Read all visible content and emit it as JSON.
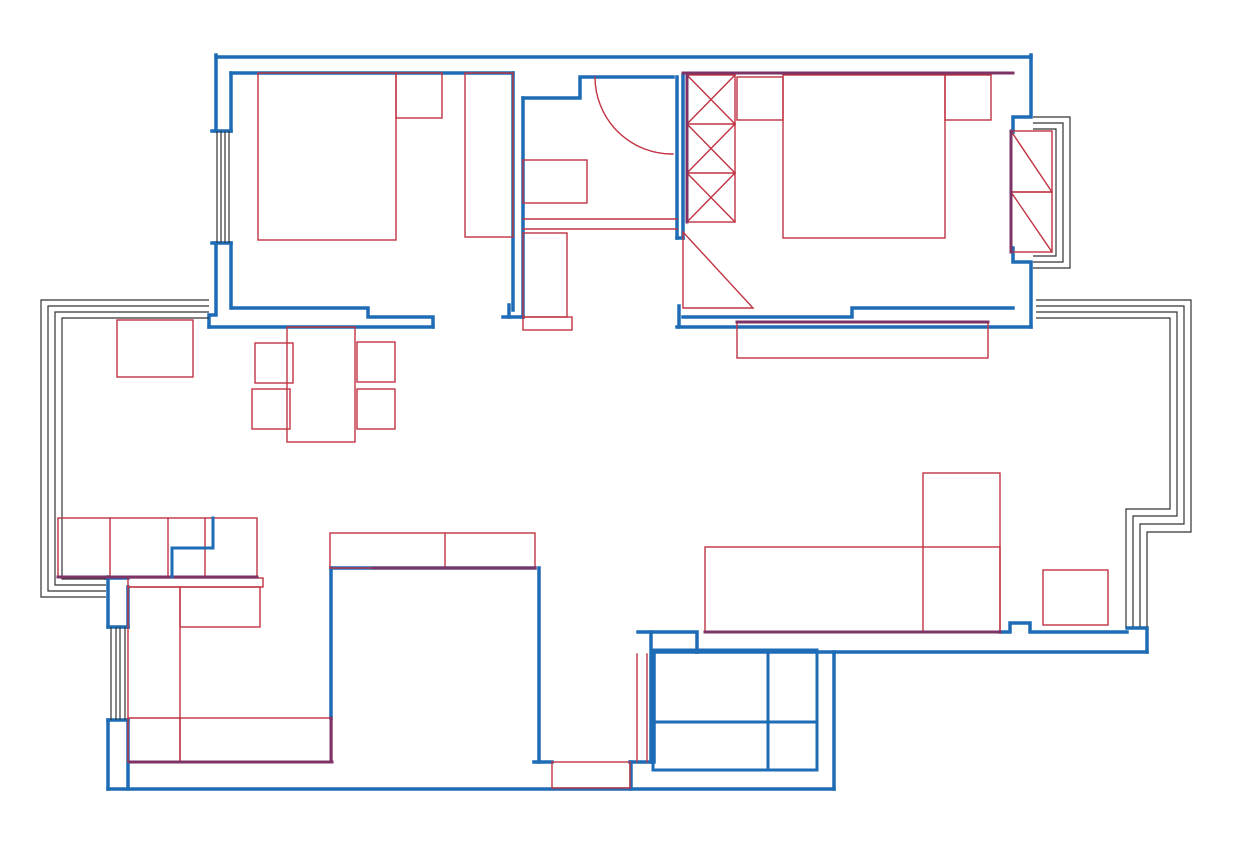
{
  "meta": {
    "description": "apartment-floor-plan-cad-drawing",
    "canvas": {
      "width": 1239,
      "height": 849,
      "background": "#ffffff"
    },
    "colors": {
      "wall_blue": "#1e6cb5",
      "furniture_red": "#c13343",
      "overlap_purple": "#7d3366",
      "frame_dark": "#333333"
    },
    "stroke_widths": {
      "wall": 3.5,
      "furniture": 1.4,
      "frame": 1.2,
      "overlap": 3,
      "fixture": 3
    }
  },
  "walls": [
    "M 216 57 H 1031",
    "M 216 55 V 131",
    "M 216 243 V 315 H 209 V 327",
    "M 209 327 H 433",
    "M 233 308 H 368 V 317 H 433 V 327",
    "M 231 73 V 131",
    "M 231 243 V 308",
    "M 231 73 H 513",
    "M 513 73 V 310",
    "M 523 98 V 317",
    "M 523 98 H 580 V 77 H 673",
    "M 677 77 V 238",
    "M 683 75 V 238",
    "M 677 238 H 683",
    "M 679 306 V 327",
    "M 683 317 H 852 V 308 H 1013",
    "M 677 327 H 1031",
    "M 1031 55 V 117 H 1013 V 132",
    "M 1013 248 V 262 H 1031 V 327",
    "M 212 131 H 231",
    "M 212 243 H 231",
    "M 108 627 H 128",
    "M 108 720 H 128",
    "M 509 305 V 317",
    "M 503 317 H 523",
    "M 638 632 H 697 V 652",
    "M 654 652 H 697",
    "M 697 652 H 1147",
    "M 1000 632 H 1010 V 623 H 1030 V 632 H 1127",
    "M 1127 628 H 1147 V 652",
    "M 651 632 V 762",
    "M 654 652 V 762",
    "M 630 762 H 653",
    "M 631 762 V 789",
    "M 108 789 H 834",
    "M 834 652 V 789",
    "M 539 568 V 762",
    "M 534 762 H 552",
    "M 331 568 H 535",
    "M 331 568 V 718"
  ],
  "kitchen_walls": [
    "M 108 577 V 627",
    "M 108 720 V 789",
    "M 128 587 V 627",
    "M 128 720 V 789",
    "M 106 578 H 128"
  ],
  "blue_fixtures": [
    "M 213 518 V 548 H 172 V 577",
    "M 653 650 H 817 V 770 H 653 Z",
    "M 768 650 V 770",
    "M 657 722 H 817"
  ],
  "overlap_lines": [
    "M 683 73 H 1013",
    "M 737 322 H 988",
    "M 705 632 H 1000",
    "M 58 577 H 257",
    "M 130 762 H 332",
    "M 331 718 V 762",
    "M 373 568 H 535",
    "M 687 75 V 222",
    "M 1011 131 V 252"
  ],
  "window_lines": [
    "M 217 131 V 243",
    "M 221 131 V 243",
    "M 225 131 V 243",
    "M 229 131 V 243",
    "M 111 627 V 720",
    "M 116 627 V 720",
    "M 120 627 V 720",
    "M 125 627 V 720",
    "M 1033 117 H 1070 V 268 H 1033",
    "M 1033 123 H 1063 V 262 H 1033",
    "M 1033 129 H 1056 V 256 H 1033"
  ],
  "railing_lines": [
    "M 209 300 H 41 V 597 H 106",
    "M 209 306 H 48 V 591 H 106",
    "M 209 312 H 55 V 585 H 106",
    "M 209 318 H 62 V 579 H 106",
    "M 1036 300 H 1191 V 532 H 1147 V 627",
    "M 1036 306 H 1184 V 524 H 1140 V 627",
    "M 1036 312 H 1177 V 516 H 1133 V 627",
    "M 1036 318 H 1170 V 509 H 1126 V 627"
  ],
  "furniture_rects": [
    {
      "name": "bed-left-bedroom",
      "x": 258,
      "y": 73,
      "w": 138,
      "h": 167
    },
    {
      "name": "nightstand-left-bedroom",
      "x": 396,
      "y": 73,
      "w": 46,
      "h": 45
    },
    {
      "name": "wardrobe-left-bedroom",
      "x": 465,
      "y": 73,
      "w": 48,
      "h": 164
    },
    {
      "name": "bathroom-cabinet",
      "x": 523,
      "y": 160,
      "w": 64,
      "h": 43
    },
    {
      "name": "hall-tall-cabinet",
      "x": 523,
      "y": 233,
      "w": 44,
      "h": 84
    },
    {
      "name": "hall-small-cabinet",
      "x": 523,
      "y": 317,
      "w": 49,
      "h": 13
    },
    {
      "name": "wardrobe-right-bedroom",
      "x": 687,
      "y": 75,
      "w": 48,
      "h": 147
    },
    {
      "name": "nightstand-right-bedroom-left",
      "x": 737,
      "y": 77,
      "w": 46,
      "h": 43
    },
    {
      "name": "bed-right-bedroom",
      "x": 783,
      "y": 75,
      "w": 162,
      "h": 163
    },
    {
      "name": "nightstand-right-bedroom-right",
      "x": 945,
      "y": 75,
      "w": 46,
      "h": 45
    },
    {
      "name": "radiator-upper",
      "x": 1011,
      "y": 131,
      "w": 41,
      "h": 61
    },
    {
      "name": "radiator-lower",
      "x": 1011,
      "y": 192,
      "w": 41,
      "h": 60
    },
    {
      "name": "tv-cabinet",
      "x": 737,
      "y": 322,
      "w": 251,
      "h": 36
    },
    {
      "name": "dining-table",
      "x": 287,
      "y": 327,
      "w": 68,
      "h": 115
    },
    {
      "name": "dining-chair-top-left",
      "x": 255,
      "y": 343,
      "w": 38,
      "h": 40
    },
    {
      "name": "dining-chair-bottom-left",
      "x": 252,
      "y": 389,
      "w": 38,
      "h": 40
    },
    {
      "name": "dining-chair-top-right",
      "x": 357,
      "y": 342,
      "w": 38,
      "h": 40
    },
    {
      "name": "dining-chair-bottom-right",
      "x": 357,
      "y": 389,
      "w": 38,
      "h": 40
    },
    {
      "name": "side-cabinet-bay",
      "x": 117,
      "y": 320,
      "w": 76,
      "h": 57
    },
    {
      "name": "bench-block",
      "x": 58,
      "y": 518,
      "w": 199,
      "h": 59
    },
    {
      "name": "kitchen-counter-band",
      "x": 128,
      "y": 578,
      "w": 135,
      "h": 9
    },
    {
      "name": "kitchen-counter-left",
      "x": 128,
      "y": 587,
      "w": 52,
      "h": 175
    },
    {
      "name": "kitchen-appliance",
      "x": 180,
      "y": 587,
      "w": 80,
      "h": 40
    },
    {
      "name": "kitchen-counter-bottom",
      "x": 180,
      "y": 718,
      "w": 152,
      "h": 44
    },
    {
      "name": "corridor-cabinet-band",
      "x": 330,
      "y": 533,
      "w": 205,
      "h": 35
    },
    {
      "name": "entry-threshold",
      "x": 552,
      "y": 762,
      "w": 78,
      "h": 26
    },
    {
      "name": "sofa",
      "x": 705,
      "y": 547,
      "w": 295,
      "h": 85
    },
    {
      "name": "sofa-chaise",
      "x": 923,
      "y": 473,
      "w": 77,
      "h": 159
    },
    {
      "name": "side-table",
      "x": 1043,
      "y": 570,
      "w": 65,
      "h": 55
    }
  ],
  "furniture_lines": [
    "M 110 518 V 577",
    "M 168 518 V 577",
    "M 205 518 V 577",
    "M 445 533 V 568",
    "M 128 718 H 180",
    "M 523 219 H 677",
    "M 523 229 H 677",
    "M 687 124 H 735",
    "M 687 173 H 735",
    "M 687 75 L 735 124",
    "M 735 75 L 687 124",
    "M 687 124 L 735 173",
    "M 735 124 L 687 173",
    "M 687 173 L 735 222",
    "M 735 173 L 687 222",
    "M 1011 131 L 1052 192",
    "M 1011 192 L 1052 252",
    "M 637 654 V 762",
    "M 647 654 V 762",
    "M 595 77 A 77 77 0 0 0 673 154",
    "M 683 232 L 683 308 L 753 308 Z"
  ]
}
